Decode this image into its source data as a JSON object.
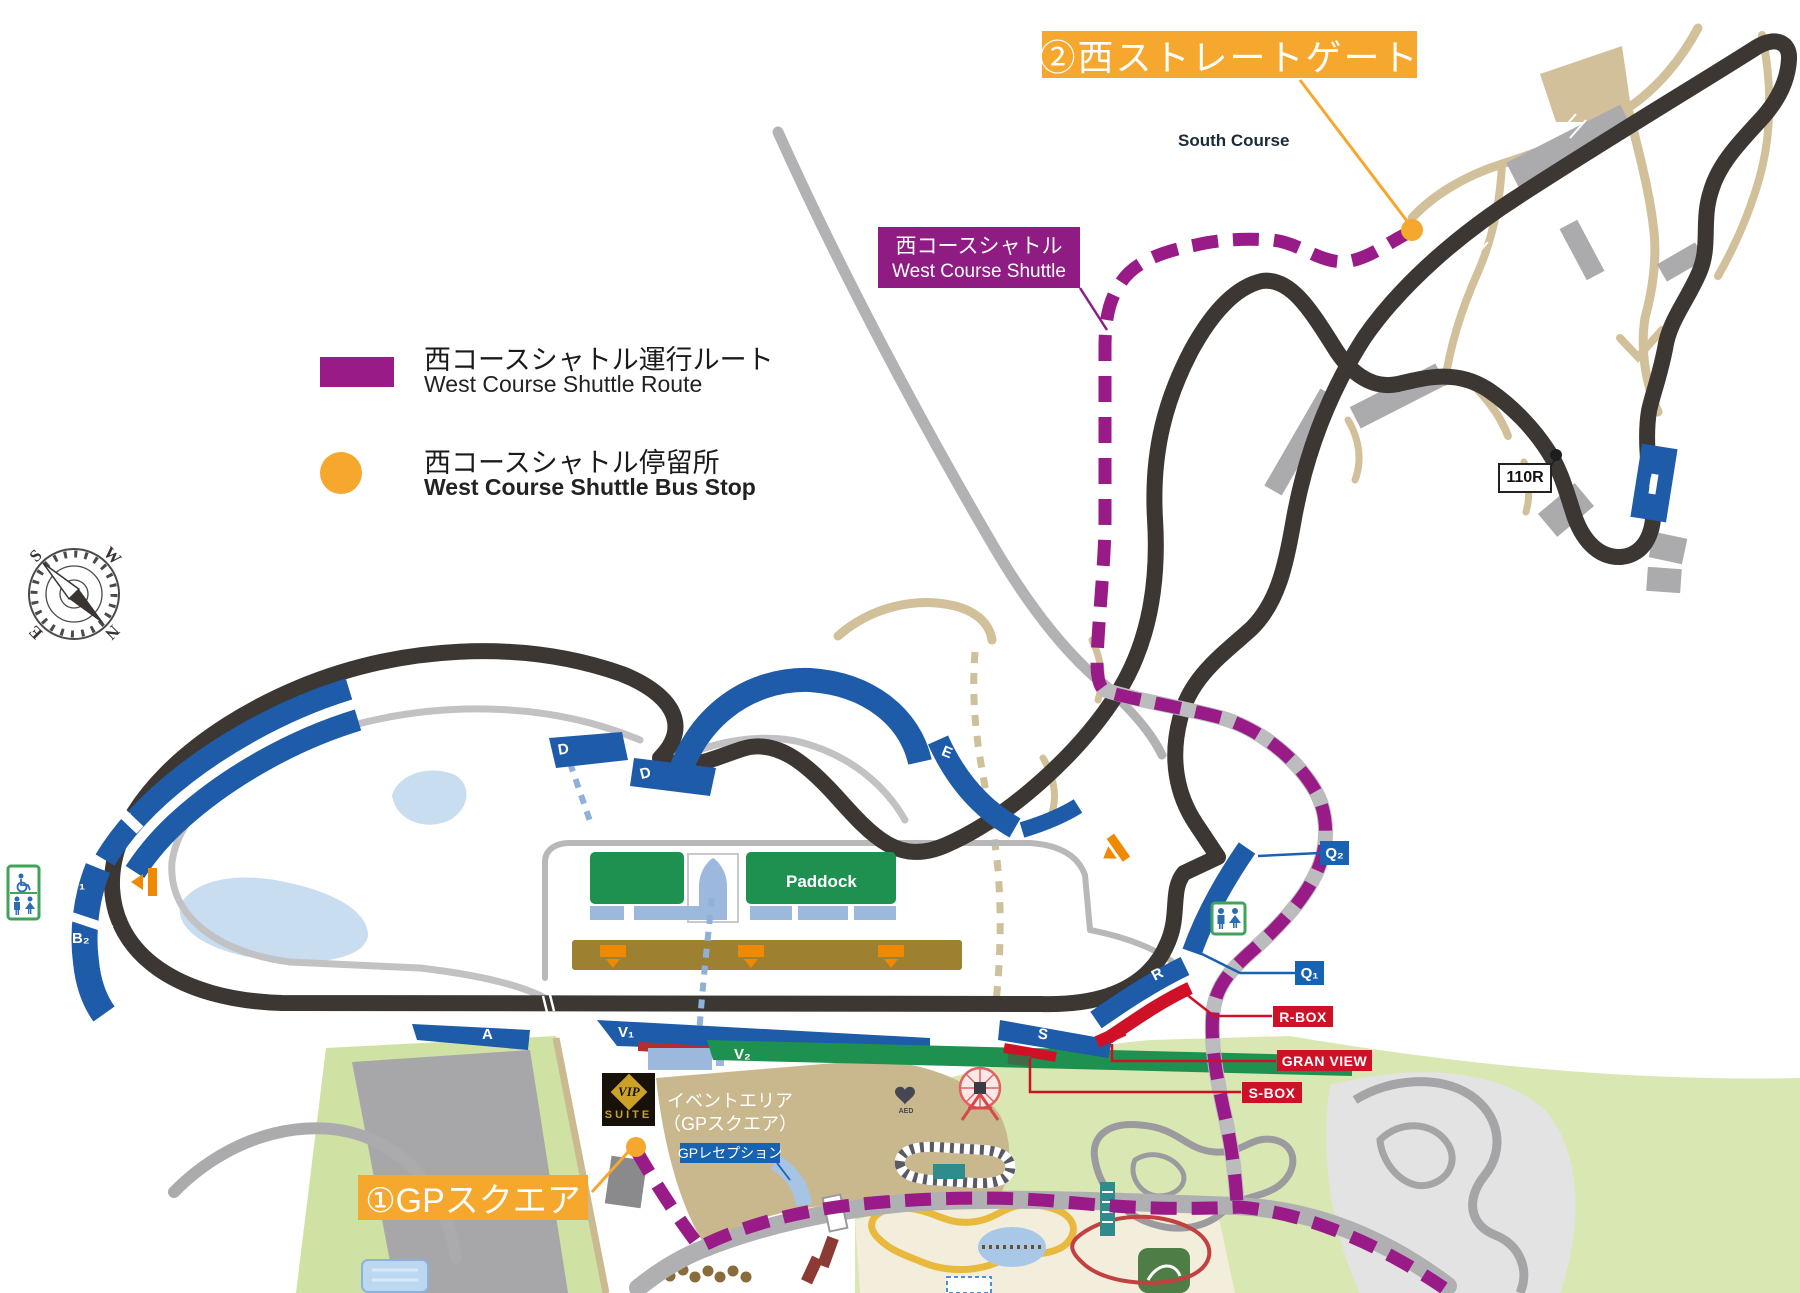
{
  "banners": {
    "west_straight_gate": "②西ストレートゲート",
    "gp_square": "①GPスクエア",
    "shuttle_jp": "西コースシャトル",
    "shuttle_en": "West Course Shuttle"
  },
  "legend": {
    "route_jp": "西コースシャトル運行ルート",
    "route_en": "West Course Shuttle Route",
    "stop_jp": "西コースシャトル停留所",
    "stop_en": "West Course Shuttle Bus Stop"
  },
  "map_labels": {
    "south_course": "South Course",
    "paddock": "Paddock",
    "corner_110r": "110R",
    "event_area_line1": "イベントエリア",
    "event_area_line2": "（GPスクエア）",
    "gp_reception": "GPレセプション",
    "vip_top": "VIP",
    "vip_bottom": "SUITE",
    "aed": "AED",
    "r_box": "R-BOX",
    "gran_view": "GRAN VIEW",
    "s_box": "S-BOX"
  },
  "stands": {
    "a": "A",
    "b1": "B₁",
    "b2": "B₂",
    "c_outer": "C",
    "c_inner": "C",
    "d_left": "D",
    "d_right": "D",
    "e": "E",
    "i": "I",
    "q1": "Q₁",
    "q2": "Q₂",
    "r": "R",
    "s": "S",
    "v1": "V₁",
    "v2": "V₂"
  },
  "compass": {
    "n": "N",
    "s": "S",
    "e": "E",
    "w": "W"
  },
  "colors": {
    "shuttle_route": "#991B87",
    "bus_stop": "#F5A72E",
    "stand_blue": "#1E5BA9",
    "track_dark": "#3D3734",
    "paddock_green": "#1E9150",
    "alert_red": "#CE1126"
  }
}
